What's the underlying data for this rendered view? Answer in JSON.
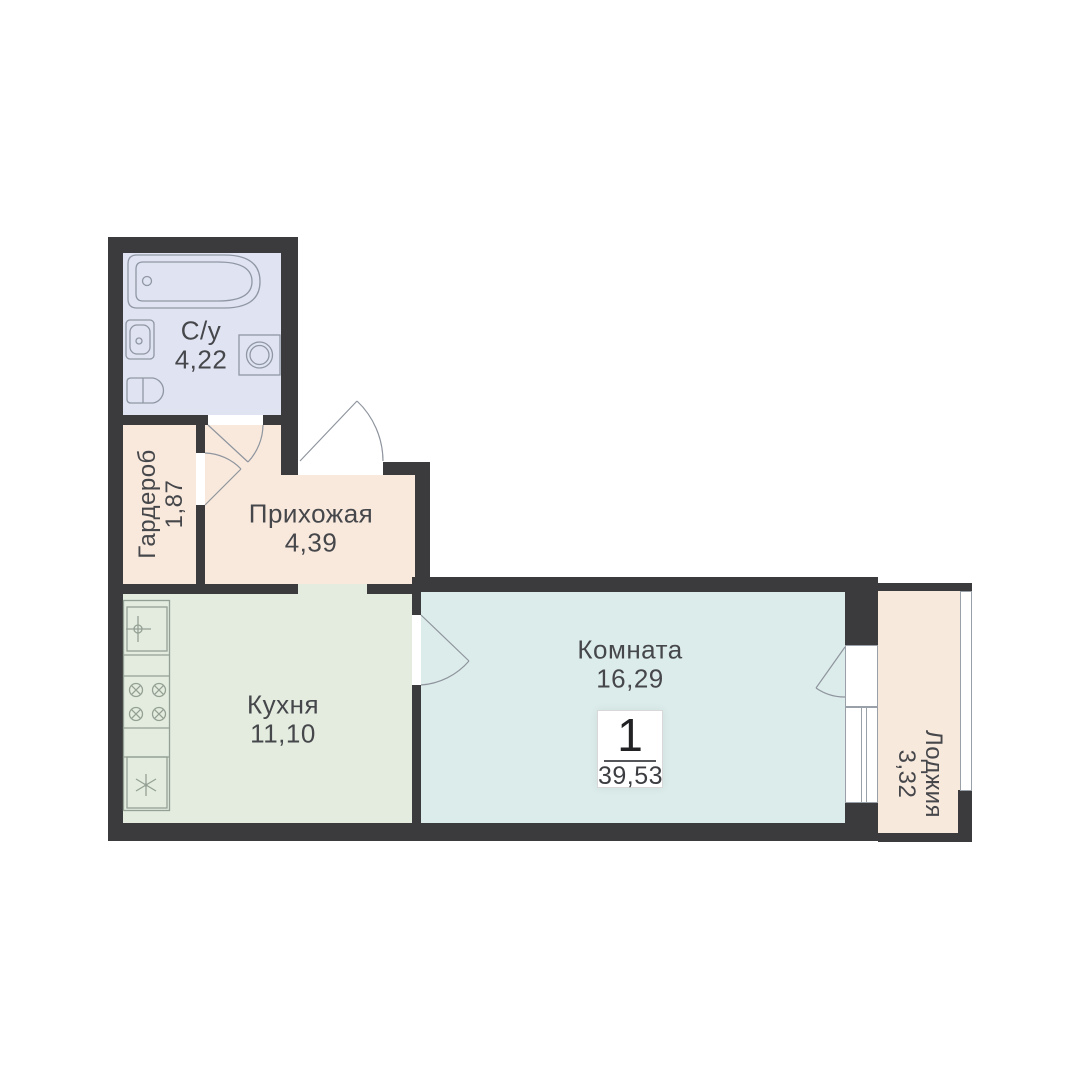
{
  "badge": {
    "rooms_count": "1",
    "total_area": "39,53"
  },
  "rooms": {
    "bathroom": {
      "label": "С/у",
      "area": "4,22"
    },
    "wardrobe": {
      "label": "Гардероб",
      "area": "1,87"
    },
    "hallway": {
      "label": "Прихожая",
      "area": "4,39"
    },
    "kitchen": {
      "label": "Кухня",
      "area": "11,10"
    },
    "living_room": {
      "label": "Комната",
      "area": "16,29"
    },
    "loggia": {
      "label": "Лоджия",
      "area": "3,32"
    }
  },
  "colors": {
    "wall": "#3b3b3d",
    "bathroom_fill": "#dfe3f2",
    "hallway_fill": "#f9e9dd",
    "wardrobe_fill": "#f9e9dd",
    "kitchen_fill": "#e3ecdf",
    "room_fill": "#dcecea",
    "loggia_fill": "#f8e9dd",
    "counter_fill": "#edf2ea",
    "fixture_stroke": "#9097a3",
    "kitchen_fixture_stroke": "#95a094",
    "door_stroke": "#8f959e",
    "text": "#46474b"
  },
  "icons": {
    "fixtures": [
      "bathtub-icon",
      "bathroom-sink-icon",
      "toilet-icon",
      "washing-machine-icon",
      "kitchen-sink-icon",
      "faucet-cross-icon",
      "stove-burners-icon",
      "fridge-snowflake-icon"
    ],
    "openings": [
      "entry-door-swing-icon",
      "bathroom-door-swing-icon",
      "wardrobe-door-swing-icon",
      "kitchen-door-swing-icon",
      "balcony-door-swing-icon",
      "window-icon",
      "loggia-glazing-icon"
    ]
  }
}
